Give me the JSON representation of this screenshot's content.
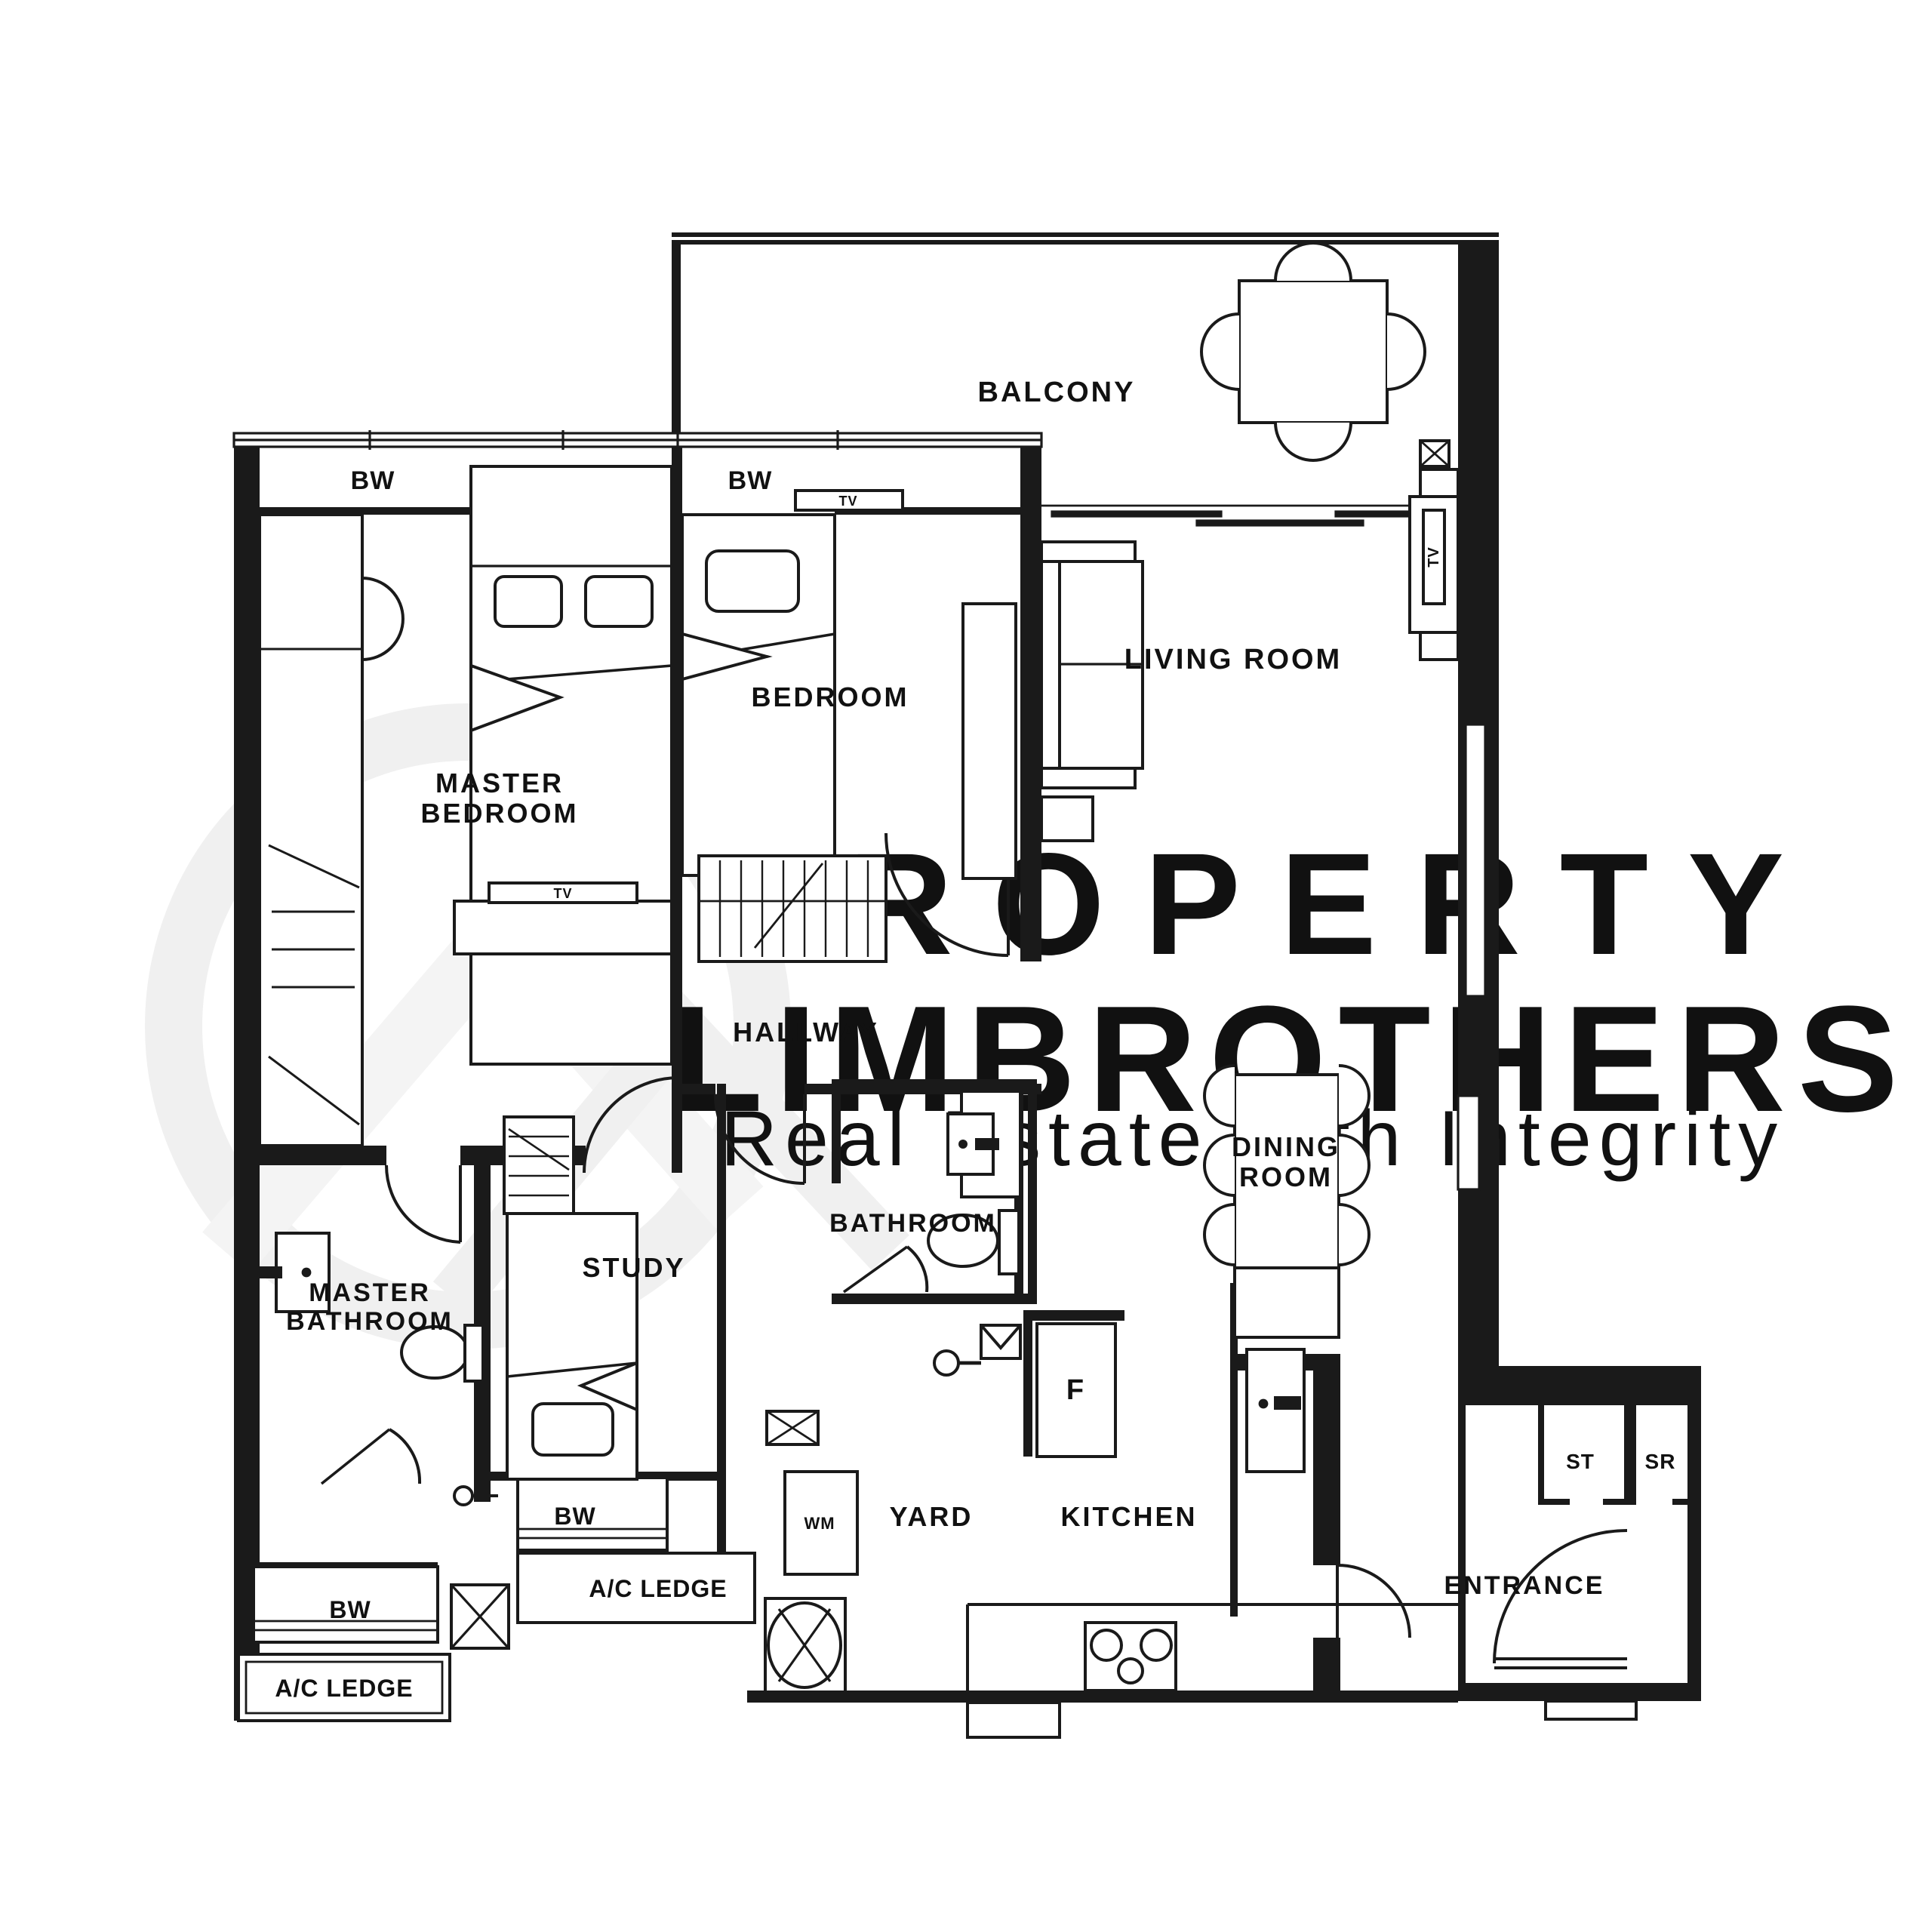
{
  "watermark": {
    "line1": "PROPERTY",
    "line2": "LIMBROTHERS",
    "tagline": "Real Estate with Integrity"
  },
  "labels": {
    "balcony": "BALCONY",
    "living_room": "LIVING ROOM",
    "bedroom": "BEDROOM",
    "master_bedroom_l1": "MASTER",
    "master_bedroom_l2": "BEDROOM",
    "hallway": "HALLWAY",
    "dining_l1": "DINING",
    "dining_l2": "ROOM",
    "master_bath_l1": "MASTER",
    "master_bath_l2": "BATHROOM",
    "study": "STUDY",
    "bathroom": "BATHROOM",
    "kitchen": "KITCHEN",
    "yard": "YARD",
    "entrance": "ENTRANCE",
    "fridge": "F",
    "washing_machine": "WM",
    "store": "ST",
    "shelter": "SR",
    "bay_window": "BW",
    "tv": "TV",
    "ac_ledge": "A/C LEDGE"
  },
  "colors": {
    "line": "#1a1a1a",
    "watermark_text": "#ececec",
    "watermark_logo": "#f0f0f0"
  }
}
